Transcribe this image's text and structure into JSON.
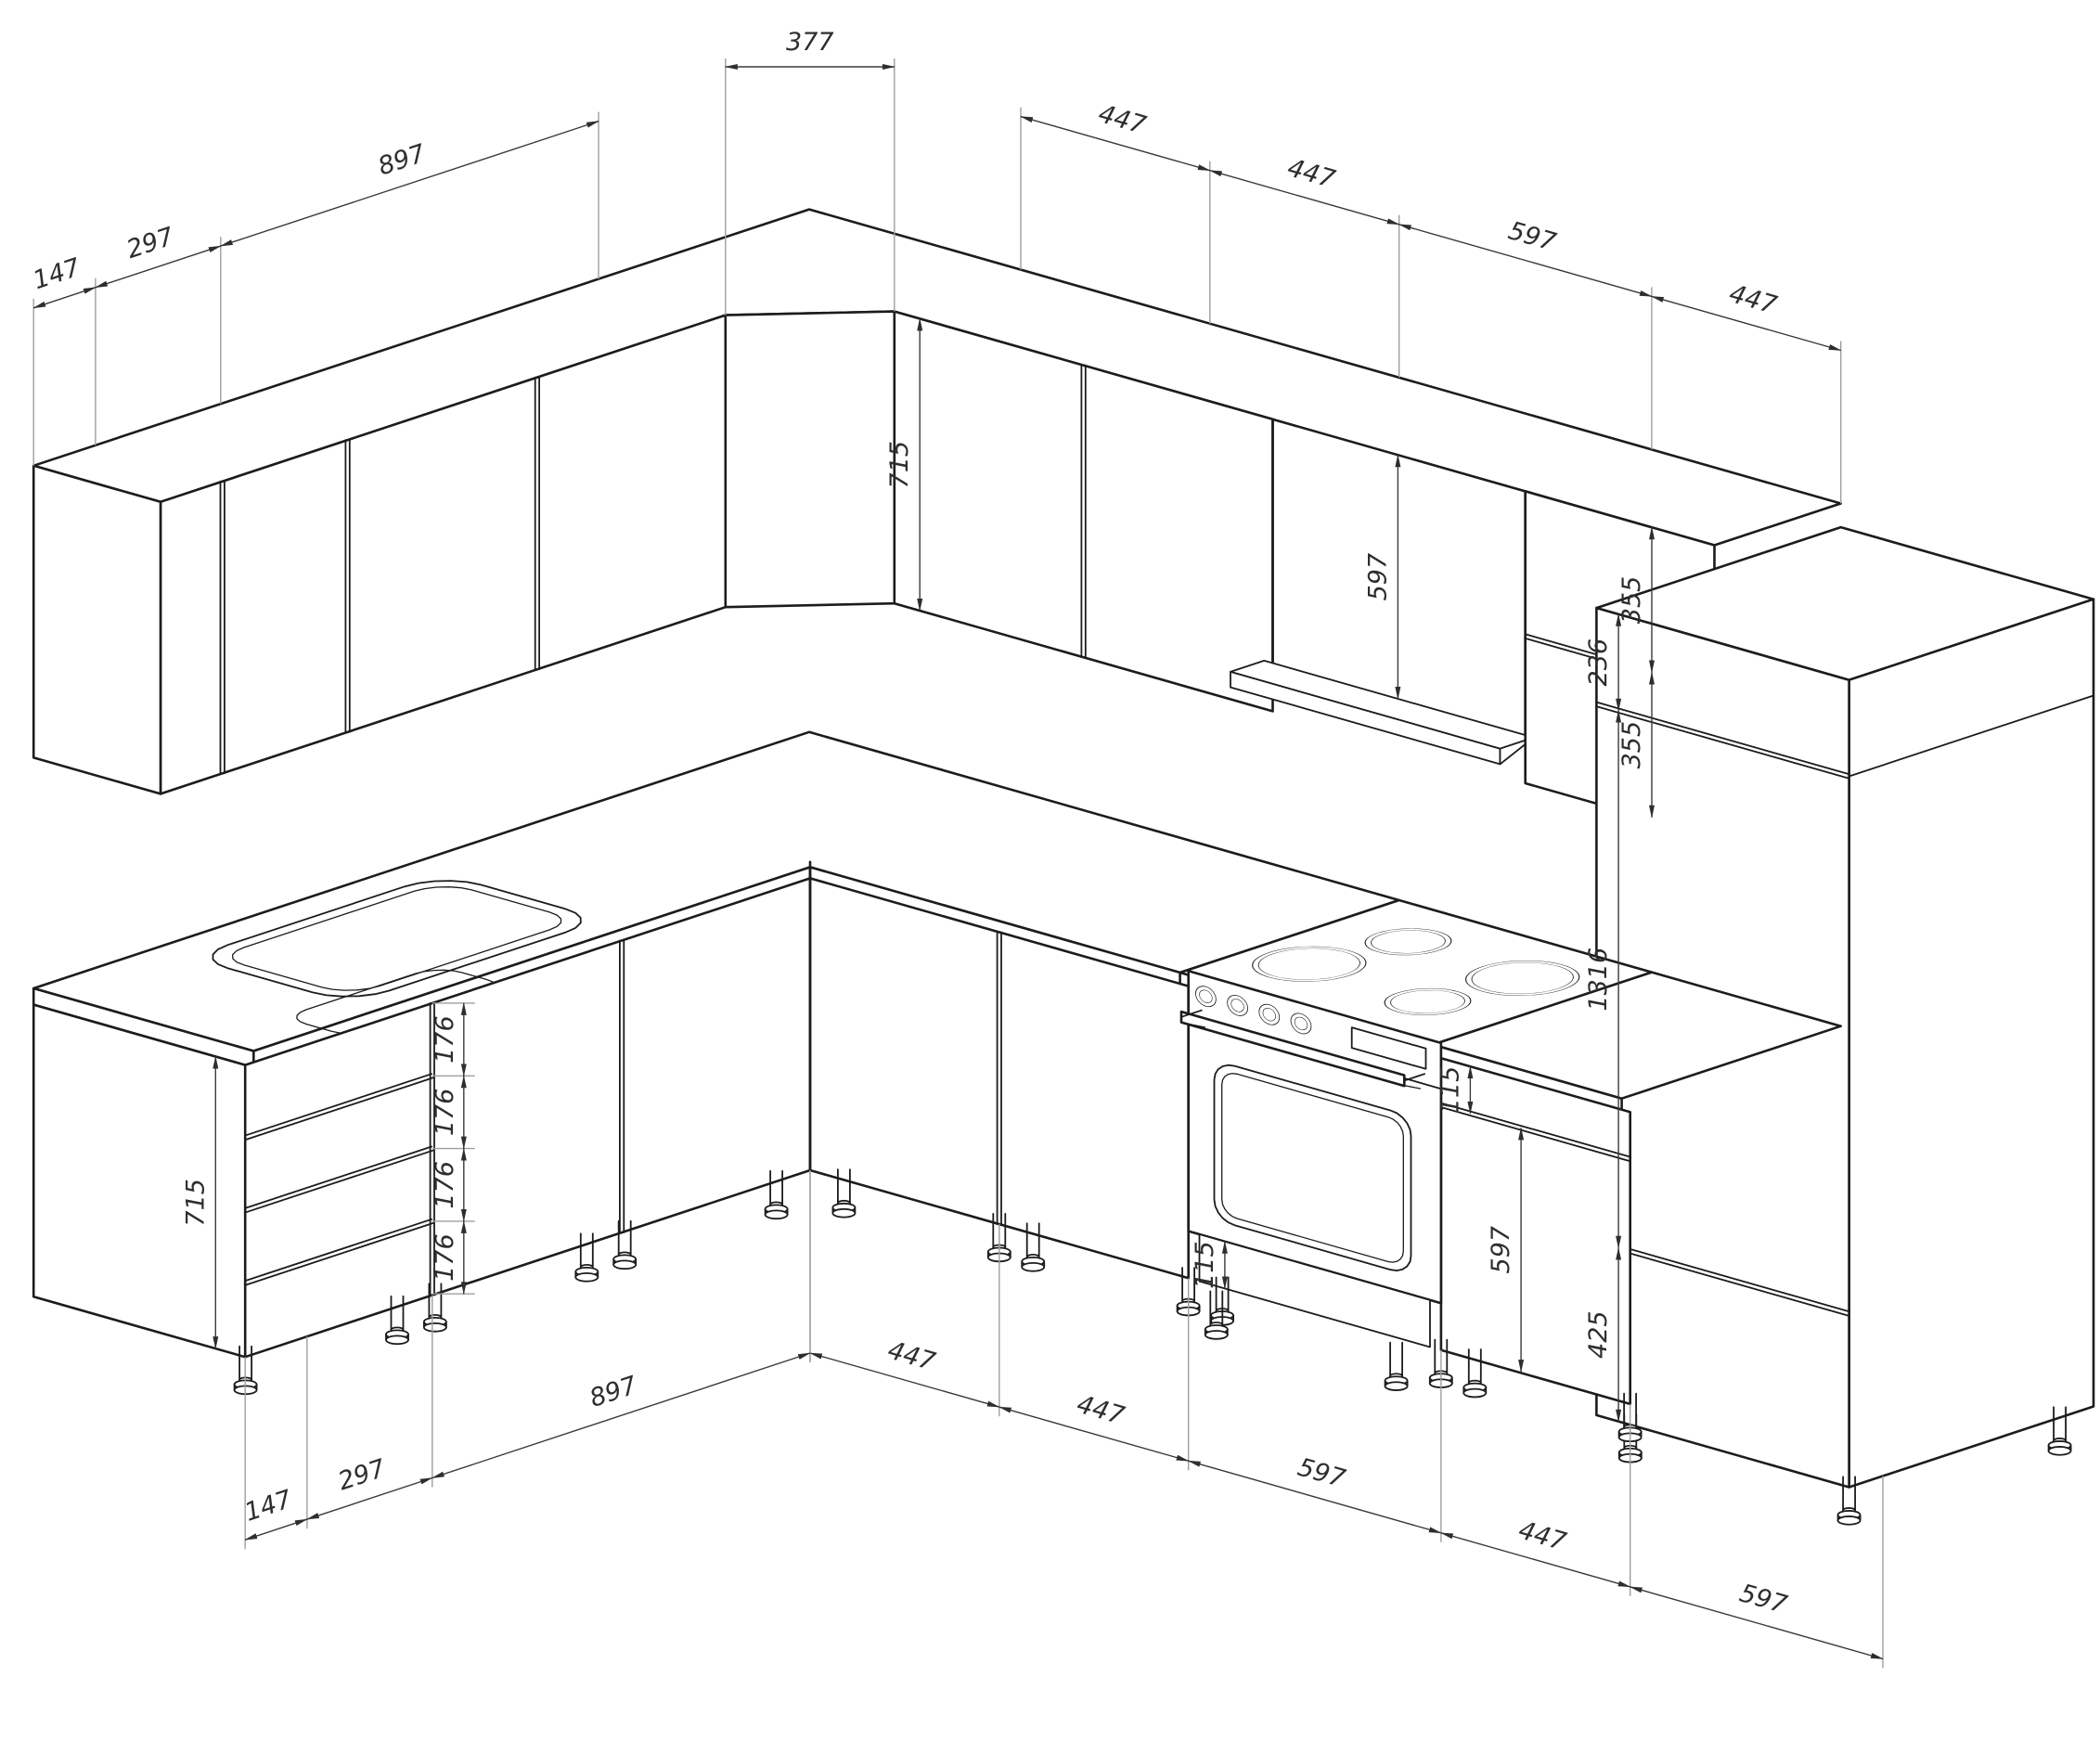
{
  "drawing": {
    "kind": "kitchen-corner-isometric-dimension-drawing",
    "units": "mm",
    "colors": {
      "line": "#1c1c1c",
      "dimension": "#3a3a3a",
      "extension": "#9f9f9f",
      "background": "#ffffff"
    },
    "dims": {
      "top_left_chain": [
        "147",
        "297",
        "897"
      ],
      "corner_width": "377",
      "top_right_chain": [
        "447",
        "447",
        "597",
        "447"
      ],
      "upper_cabinet_height": "715",
      "upper_open_height": "597",
      "upper_split_heights": [
        "355",
        "355"
      ],
      "tall_sections": [
        "236",
        "1316",
        "425"
      ],
      "drawer_heights": [
        "176",
        "176",
        "176",
        "176"
      ],
      "base_end_height": "715",
      "oven_plinth_height": "115",
      "base_drawer_height": "115",
      "base_door_height": "597",
      "bottom_left_chain": [
        "147",
        "297",
        "897"
      ],
      "bottom_right_chain": [
        "447",
        "447",
        "597",
        "447",
        "597"
      ]
    }
  }
}
